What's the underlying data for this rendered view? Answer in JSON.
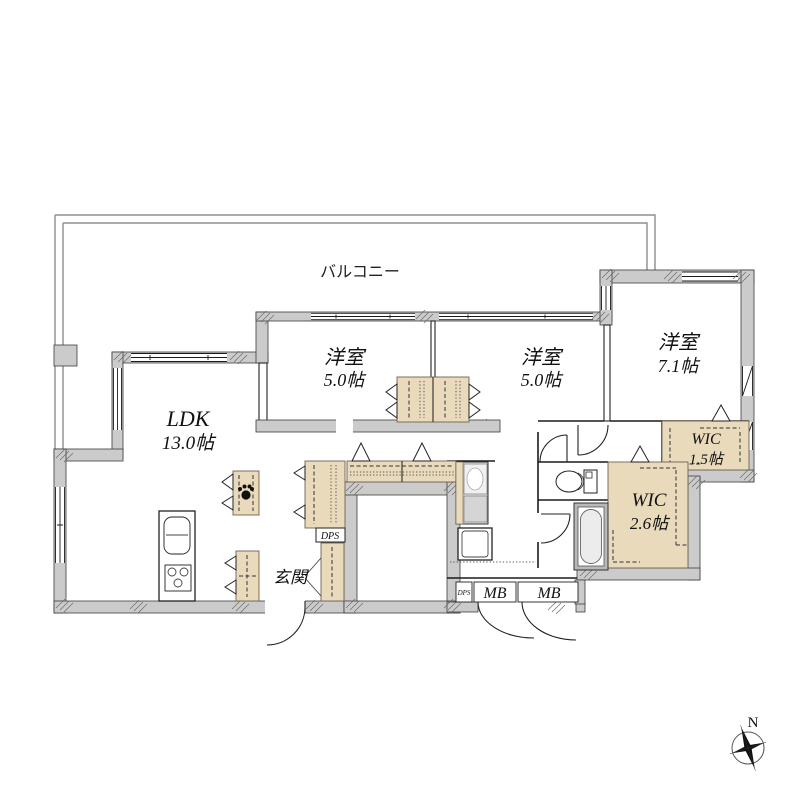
{
  "floorplan": {
    "balcony": {
      "label": "バルコニー"
    },
    "rooms": {
      "bedroom1": {
        "name": "洋室",
        "size": "5.0帖"
      },
      "bedroom2": {
        "name": "洋室",
        "size": "5.0帖"
      },
      "bedroom3": {
        "name": "洋室",
        "size": "7.1帖"
      },
      "ldk": {
        "name": "LDK",
        "size": "13.0帖"
      },
      "wic1": {
        "name": "WIC",
        "size": "1.5帖"
      },
      "wic2": {
        "name": "WIC",
        "size": "2.6帖"
      },
      "genkan": {
        "name": "玄関"
      }
    },
    "utility": {
      "dps_hall": "DPS",
      "dps_meter": "DPS",
      "mb_left": "MB",
      "mb_right": "MB"
    },
    "compass": {
      "north": "N"
    },
    "colors": {
      "wall": "#cbcbcb",
      "closet": "#e9dabc",
      "line": "#1b1b1b",
      "rail": "#8f8f8f",
      "background": "#ffffff"
    }
  }
}
